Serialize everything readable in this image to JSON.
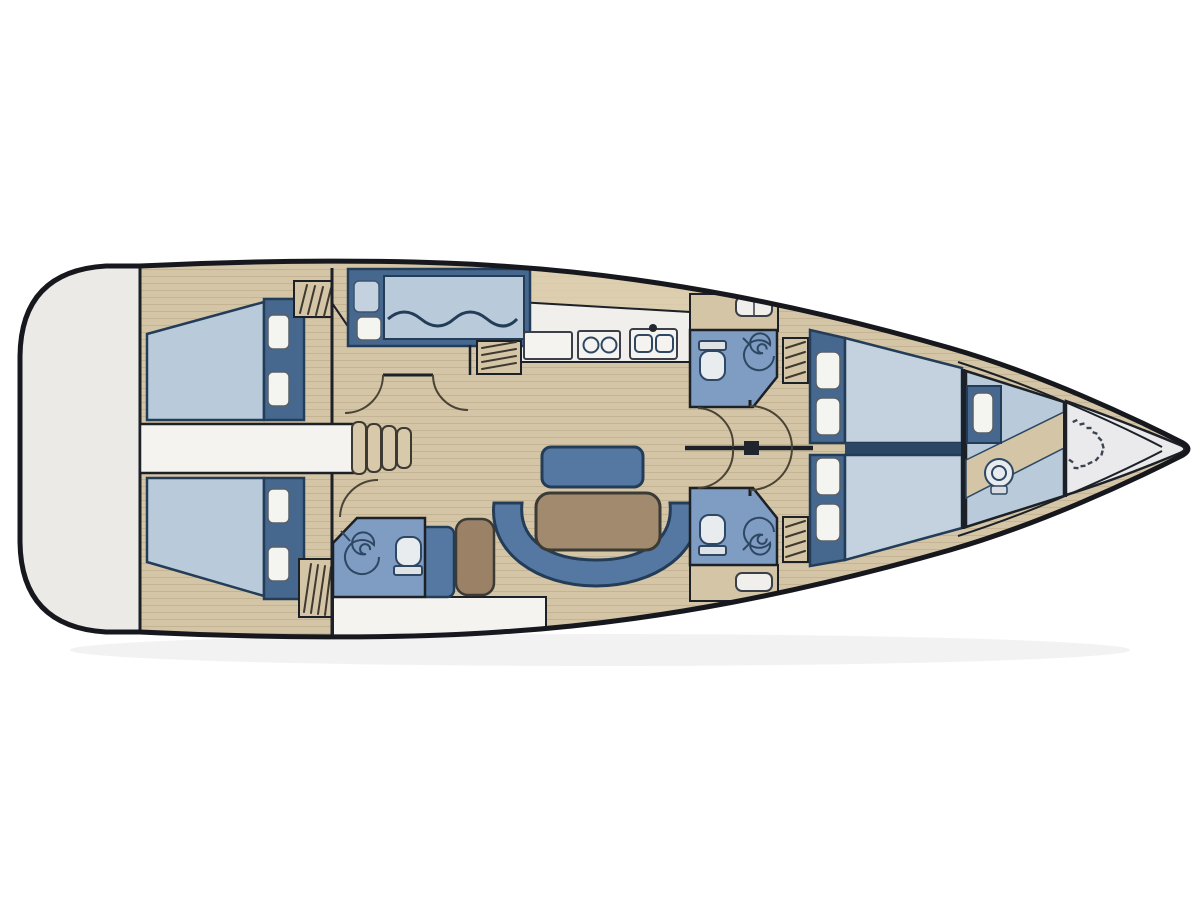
{
  "canvas": {
    "width": 1200,
    "height": 898
  },
  "diagram": {
    "type": "yacht-interior-floor-plan",
    "orientation": "bow-right",
    "visible_text": ""
  },
  "colors": {
    "background": "#ffffff",
    "hull_outline": "#16181e",
    "wall": "#1c2027",
    "deck": "#d4c5a6",
    "deck_light": "#ddd0b2",
    "plank_line": "#b39f7e",
    "platform": "#ebeae7",
    "walkway": "#f4f3f0",
    "counter": "#f1efec",
    "navy": "#46688f",
    "furn_border": "#233c58",
    "berth": "#b9cbda",
    "berth_light": "#c3d2de",
    "berth_divider": "#2c4763",
    "settee": "#5578a2",
    "head_floor": "#7f9cc2",
    "table": "#a18a6d",
    "chair": "#9b8266",
    "pillow": "#f4f4f1",
    "fixture_fill": "#e9ecef",
    "fixture_line": "#2e4763",
    "hatch_line": "#3e3a30",
    "door_arc": "#4a4336",
    "anchor_locker": "#eaeaec",
    "chain": "#3d4450",
    "mast": "#20242c",
    "shadow": "#000000"
  },
  "icons": {
    "toilet-icon": "rounded bowl outline with tank bar",
    "shower-icon": "spiral drain",
    "sink-icon": "double basin with faucet dot",
    "stove-icon": "two burner circles",
    "basin-icon": "small rounded basin",
    "steps-icon": "nested companionway treads",
    "locker-icon": "diagonal hatch marks",
    "anchor-chain-icon": "dashed chain curve",
    "mast-icon": "filled square on corridor wall"
  }
}
